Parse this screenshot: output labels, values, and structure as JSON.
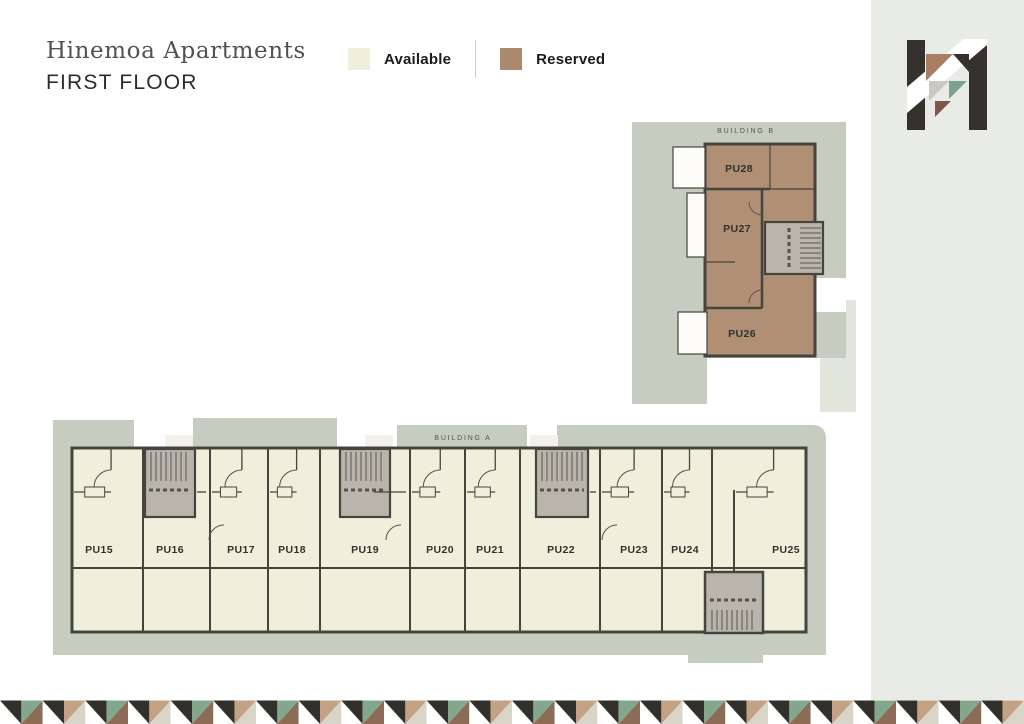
{
  "header": {
    "title": "Hinemoa Apartments",
    "subtitle": "FIRST FLOOR"
  },
  "legend": {
    "items": [
      {
        "label": "Available",
        "color": "#eff0dc"
      },
      {
        "label": "Reserved",
        "color": "#ab8a6f"
      }
    ]
  },
  "colors": {
    "surround": "#c6ccc0",
    "surround_light": "#e1e5db",
    "unit_available": "#eff0dc",
    "unit_reserved": "#b08f75",
    "balcony_bump": "#f4f1ea",
    "balcony_white": "#fdfcf9",
    "stair": "#b9b5ad",
    "tread": "#57544e",
    "wall": "#45443e",
    "sidebar": "#e9ebe6",
    "logo_dark": "#35322d",
    "logo_brown": "#a87f62",
    "logo_green": "#7ea28a",
    "logo_gray": "#cbc8bf",
    "logo_rust": "#7c584a"
  },
  "building_a": {
    "label": "BUILDING A",
    "status": "available",
    "units": [
      {
        "id": "PU15",
        "status": "available",
        "x1": 72,
        "x2": 143,
        "cx": 99
      },
      {
        "id": "PU16",
        "status": "available",
        "x1": 143,
        "x2": 210,
        "cx": 170,
        "stair": true
      },
      {
        "id": "PU17",
        "status": "available",
        "x1": 210,
        "x2": 268,
        "cx": 241
      },
      {
        "id": "PU18",
        "status": "available",
        "x1": 268,
        "x2": 320,
        "cx": 292
      },
      {
        "id": "PU19",
        "status": "available",
        "x1": 320,
        "x2": 410,
        "cx": 365,
        "stair": true
      },
      {
        "id": "PU20",
        "status": "available",
        "x1": 410,
        "x2": 465,
        "cx": 440
      },
      {
        "id": "PU21",
        "status": "available",
        "x1": 465,
        "x2": 520,
        "cx": 490
      },
      {
        "id": "PU22",
        "status": "available",
        "x1": 520,
        "x2": 600,
        "cx": 561,
        "stair": true
      },
      {
        "id": "PU23",
        "status": "available",
        "x1": 600,
        "x2": 662,
        "cx": 634
      },
      {
        "id": "PU24",
        "status": "available",
        "x1": 662,
        "x2": 712,
        "cx": 685
      },
      {
        "id": "PU25",
        "status": "available",
        "x1": 734,
        "x2": 806,
        "cx": 786
      }
    ],
    "stairs": [
      145,
      340,
      536
    ],
    "stair_bumps": [
      165,
      365,
      530
    ]
  },
  "building_b": {
    "label": "BUILDING B",
    "status": "reserved",
    "units": [
      {
        "id": "PU28",
        "status": "reserved",
        "cx": 739,
        "cy": 172,
        "ry1": 144,
        "ry2": 189
      },
      {
        "id": "PU27",
        "status": "reserved",
        "cx": 737,
        "cy": 232,
        "ry1": 189,
        "ry2": 308
      },
      {
        "id": "PU26",
        "status": "reserved",
        "cx": 742,
        "cy": 337,
        "ry1": 308,
        "ry2": 356
      }
    ]
  },
  "footer_pattern": {
    "sequence": [
      "dark/white",
      "green/brown",
      "dark/white",
      "tan/gray"
    ],
    "palette": {
      "dark": "#33302b",
      "white": "#ffffff",
      "green": "#82a78c",
      "brown": "#8c6b57",
      "tan": "#c3a284",
      "gray": "#d8d4c8"
    }
  }
}
